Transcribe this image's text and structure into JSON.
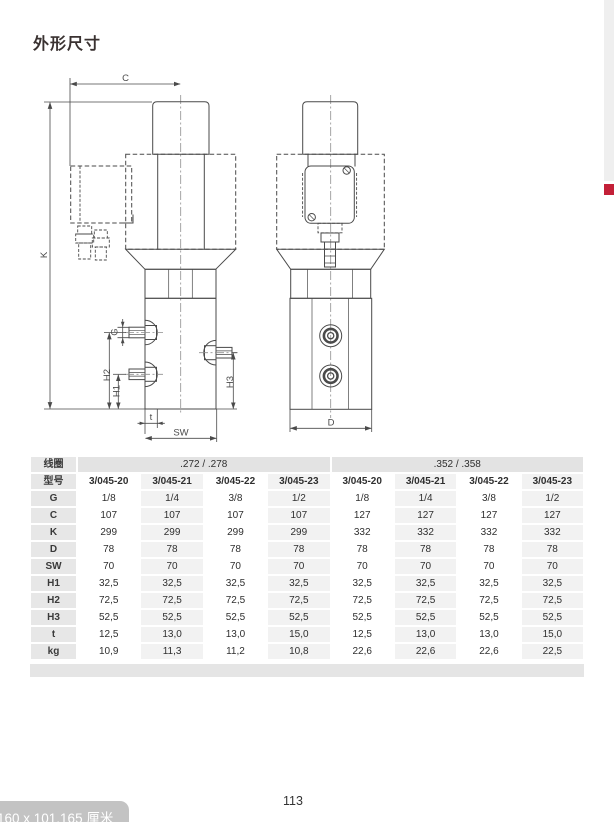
{
  "title": "外形尺寸",
  "page_number": "113",
  "size_tooltip": "160 x 101,165 厘米",
  "colors": {
    "accent_red": "#c32038",
    "table_gray": "#e7e7e7"
  },
  "drawing": {
    "labels": {
      "C": "C",
      "K": "K",
      "G": "G",
      "H1": "H1",
      "H2": "H2",
      "H3": "H3",
      "t": "t",
      "SW": "SW",
      "D": "D"
    }
  },
  "table": {
    "coil_row_label": "线圈",
    "model_row_label": "型号",
    "coil_groups": [
      ".272 / .278",
      ".352 / .358"
    ],
    "models": [
      "3/045-20",
      "3/045-21",
      "3/045-22",
      "3/045-23",
      "3/045-20",
      "3/045-21",
      "3/045-22",
      "3/045-23"
    ],
    "rows": [
      {
        "label": "G",
        "values": [
          "1/8",
          "1/4",
          "3/8",
          "1/2",
          "1/8",
          "1/4",
          "3/8",
          "1/2"
        ]
      },
      {
        "label": "C",
        "values": [
          "107",
          "107",
          "107",
          "107",
          "127",
          "127",
          "127",
          "127"
        ]
      },
      {
        "label": "K",
        "values": [
          "299",
          "299",
          "299",
          "299",
          "332",
          "332",
          "332",
          "332"
        ]
      },
      {
        "label": "D",
        "values": [
          "78",
          "78",
          "78",
          "78",
          "78",
          "78",
          "78",
          "78"
        ]
      },
      {
        "label": "SW",
        "values": [
          "70",
          "70",
          "70",
          "70",
          "70",
          "70",
          "70",
          "70"
        ]
      },
      {
        "label": "H1",
        "values": [
          "32,5",
          "32,5",
          "32,5",
          "32,5",
          "32,5",
          "32,5",
          "32,5",
          "32,5"
        ]
      },
      {
        "label": "H2",
        "values": [
          "72,5",
          "72,5",
          "72,5",
          "72,5",
          "72,5",
          "72,5",
          "72,5",
          "72,5"
        ]
      },
      {
        "label": "H3",
        "values": [
          "52,5",
          "52,5",
          "52,5",
          "52,5",
          "52,5",
          "52,5",
          "52,5",
          "52,5"
        ]
      },
      {
        "label": "t",
        "values": [
          "12,5",
          "13,0",
          "13,0",
          "15,0",
          "12,5",
          "13,0",
          "13,0",
          "15,0"
        ]
      },
      {
        "label": "kg",
        "values": [
          "10,9",
          "11,3",
          "11,2",
          "10,8",
          "22,6",
          "22,6",
          "22,6",
          "22,5"
        ]
      }
    ]
  }
}
